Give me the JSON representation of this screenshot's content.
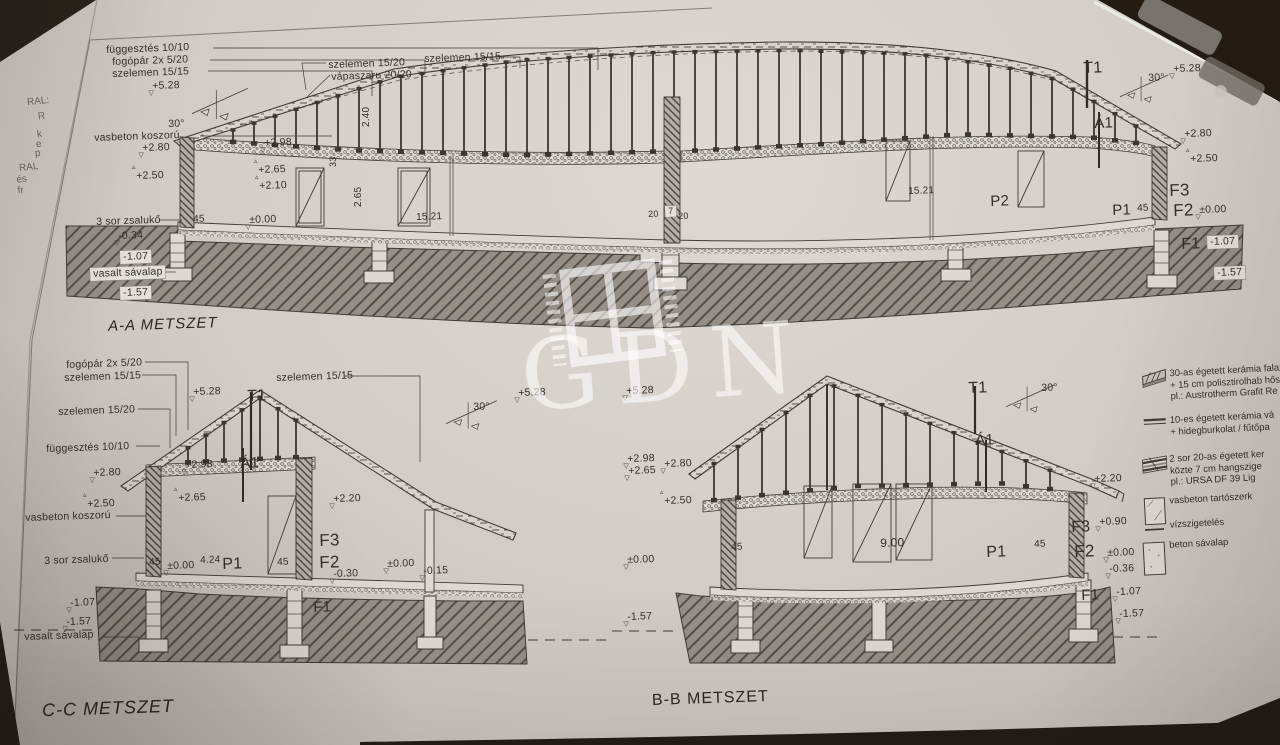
{
  "watermark": {
    "text": "GDN"
  },
  "titles": {
    "aa": "A-A METSZET",
    "cc": "C-C METSZET",
    "bb": "B-B METSZET"
  },
  "symbols": {
    "level_down": "▽",
    "level_up": "▵"
  },
  "colors": {
    "paper": "#d5cfc9",
    "ink": "#3f3b37",
    "ground_hatch": "#968f88",
    "table_dark": "#241b13",
    "watermark_white": "rgba(255,255,255,0.6)"
  },
  "side_sheet": {
    "fragments": [
      {
        "t": "RAL:",
        "x": 27,
        "y": 96
      },
      {
        "t": "R",
        "x": 38,
        "y": 111
      },
      {
        "t": "k",
        "x": 37,
        "y": 129
      },
      {
        "t": "e",
        "x": 36,
        "y": 139
      },
      {
        "t": "p",
        "x": 35,
        "y": 148
      },
      {
        "t": "RAL",
        "x": 19,
        "y": 162
      },
      {
        "t": "és fr",
        "x": 17,
        "y": 174
      }
    ]
  },
  "legend": {
    "items": [
      {
        "icon": "wall-30",
        "lines": [
          "30-as égetett kerámia falaz",
          "+ 15 cm polisztirolhab hős",
          "pl.: Austrotherm Grafit Re"
        ]
      },
      {
        "icon": "partition-10",
        "lines": [
          "10-es égetett kerámia vá",
          "+ hidegburkolat / fűtőpa"
        ]
      },
      {
        "icon": "wall-20x2",
        "lines": [
          "2 sor 20-as égetett ker",
          "közte 7 cm hangszige",
          "pl.: URSA DF 39 Lig"
        ]
      },
      {
        "icon": "rc-structure",
        "lines": [
          "vasbeton tartószerk"
        ]
      },
      {
        "icon": "waterproofing",
        "lines": [
          "vízszigetelés"
        ]
      },
      {
        "icon": "concrete-strip",
        "lines": [
          "beton sávalap"
        ]
      }
    ]
  },
  "annotations": [
    {
      "t": "függesztés 10/10",
      "x": 106,
      "y": 44
    },
    {
      "t": "fogópár 2x 5/20",
      "x": 112,
      "y": 56
    },
    {
      "t": "szelemen 15/15",
      "x": 112,
      "y": 68
    },
    {
      "t": "+5.28",
      "x": 152,
      "y": 80,
      "sym": "d"
    },
    {
      "t": "30°",
      "x": 168,
      "y": 118
    },
    {
      "t": "vasbeton koszorú",
      "x": 94,
      "y": 132
    },
    {
      "t": "+2.80",
      "x": 142,
      "y": 142,
      "sym": "d"
    },
    {
      "t": "+2.50",
      "x": 136,
      "y": 170,
      "sym": "u"
    },
    {
      "t": "szelemen 15/20",
      "x": 328,
      "y": 59
    },
    {
      "t": "vápaszaru 20/20",
      "x": 331,
      "y": 71
    },
    {
      "t": "szelemen 15/15",
      "x": 424,
      "y": 53
    },
    {
      "t": "2.40",
      "x": 361,
      "y": 127,
      "rot": -90,
      "fs": 10
    },
    {
      "t": "+2.98",
      "x": 264,
      "y": 137,
      "sym": "d"
    },
    {
      "t": "33",
      "x": 328,
      "y": 167,
      "rot": -90,
      "fs": 9
    },
    {
      "t": "+2.65",
      "x": 258,
      "y": 164,
      "sym": "u"
    },
    {
      "t": "2.65",
      "x": 353,
      "y": 207,
      "rot": -90,
      "fs": 10
    },
    {
      "t": "+2.10",
      "x": 259,
      "y": 180,
      "sym": "u"
    },
    {
      "t": "3 sor zsalukő",
      "x": 96,
      "y": 216
    },
    {
      "t": "45",
      "x": 193,
      "y": 214,
      "fs": 10
    },
    {
      "t": "±0.00",
      "x": 249,
      "y": 214,
      "sym": "d"
    },
    {
      "t": "15.21",
      "x": 416,
      "y": 212,
      "fs": 10
    },
    {
      "t": "-0.34",
      "x": 118,
      "y": 230,
      "sym": "d"
    },
    {
      "t": "-1.07",
      "x": 120,
      "y": 251,
      "box": true
    },
    {
      "t": "vasalt sávalap",
      "x": 90,
      "y": 268,
      "box": true
    },
    {
      "t": "-1.57",
      "x": 120,
      "y": 287,
      "box": true
    },
    {
      "t": "20",
      "x": 648,
      "y": 209,
      "fs": 9
    },
    {
      "t": "7",
      "x": 665,
      "y": 206,
      "fs": 9,
      "box": true
    },
    {
      "t": "20",
      "x": 678,
      "y": 211,
      "fs": 9
    },
    {
      "t": "15.21",
      "x": 908,
      "y": 186,
      "fs": 10
    },
    {
      "t": "P2",
      "x": 990,
      "y": 193,
      "fs": 15
    },
    {
      "t": "P1",
      "x": 1112,
      "y": 202,
      "fs": 15
    },
    {
      "t": "45",
      "x": 1137,
      "y": 203,
      "fs": 10
    },
    {
      "t": "T1",
      "x": 1083,
      "y": 60,
      "fs": 16
    },
    {
      "t": "30°",
      "x": 1148,
      "y": 72
    },
    {
      "t": "+5.28",
      "x": 1173,
      "y": 63,
      "sym": "d"
    },
    {
      "t": "Á1",
      "x": 1094,
      "y": 115,
      "fs": 15
    },
    {
      "t": "+2.80",
      "x": 1184,
      "y": 128,
      "sym": "d"
    },
    {
      "t": "+2.50",
      "x": 1190,
      "y": 153,
      "sym": "u"
    },
    {
      "t": "F3",
      "x": 1169,
      "y": 181,
      "fs": 17
    },
    {
      "t": "F2",
      "x": 1173,
      "y": 201,
      "fs": 17
    },
    {
      "t": "±0.00",
      "x": 1199,
      "y": 204,
      "sym": "d"
    },
    {
      "t": "F1",
      "x": 1181,
      "y": 236,
      "fs": 16
    },
    {
      "t": "-1.07",
      "x": 1207,
      "y": 236,
      "box": true
    },
    {
      "t": "-1.57",
      "x": 1214,
      "y": 267,
      "box": true
    },
    {
      "t": "fogópár 2x 5/20",
      "x": 66,
      "y": 359
    },
    {
      "t": "szelemen 15/15",
      "x": 64,
      "y": 372
    },
    {
      "t": "szelemen 15/20",
      "x": 58,
      "y": 406
    },
    {
      "t": "függesztés 10/10",
      "x": 46,
      "y": 443
    },
    {
      "t": "+5.28",
      "x": 193,
      "y": 386,
      "sym": "d"
    },
    {
      "t": "T1",
      "x": 247,
      "y": 388,
      "fs": 16
    },
    {
      "t": "szelemen 15/15",
      "x": 276,
      "y": 372
    },
    {
      "t": "30°",
      "x": 473,
      "y": 401
    },
    {
      "t": "+2.98",
      "x": 185,
      "y": 459,
      "sym": "d"
    },
    {
      "t": "Á1",
      "x": 240,
      "y": 455,
      "fs": 15
    },
    {
      "t": "+2.80",
      "x": 93,
      "y": 467,
      "sym": "d"
    },
    {
      "t": "+2.65",
      "x": 178,
      "y": 492,
      "sym": "u"
    },
    {
      "t": "+2.50",
      "x": 87,
      "y": 498,
      "sym": "u"
    },
    {
      "t": "vasbeton koszorú",
      "x": 25,
      "y": 512
    },
    {
      "t": "+2.20",
      "x": 333,
      "y": 493,
      "sym": "d"
    },
    {
      "t": "3 sor zsalukő",
      "x": 44,
      "y": 555
    },
    {
      "t": "45",
      "x": 149,
      "y": 557,
      "fs": 10
    },
    {
      "t": "±0.00",
      "x": 167,
      "y": 560,
      "sym": "d"
    },
    {
      "t": "4.24",
      "x": 200,
      "y": 555,
      "fs": 10
    },
    {
      "t": "P1",
      "x": 222,
      "y": 556,
      "fs": 16
    },
    {
      "t": "45",
      "x": 277,
      "y": 557,
      "fs": 10
    },
    {
      "t": "F3",
      "x": 319,
      "y": 531,
      "fs": 17
    },
    {
      "t": "F2",
      "x": 319,
      "y": 553,
      "fs": 17
    },
    {
      "t": "-0.30",
      "x": 333,
      "y": 568,
      "sym": "d"
    },
    {
      "t": "±0.00",
      "x": 387,
      "y": 558,
      "sym": "d"
    },
    {
      "t": "-0.15",
      "x": 423,
      "y": 565,
      "sym": "d"
    },
    {
      "t": "F1",
      "x": 313,
      "y": 599,
      "fs": 15
    },
    {
      "t": "-1.07",
      "x": 70,
      "y": 597,
      "sym": "d"
    },
    {
      "t": "-1.57",
      "x": 66,
      "y": 616,
      "sym": "d"
    },
    {
      "t": "vasalt sávalap",
      "x": 24,
      "y": 631
    },
    {
      "t": "+5.28",
      "x": 518,
      "y": 387,
      "sym": "d"
    },
    {
      "t": "+5.28",
      "x": 626,
      "y": 385,
      "sym": "d"
    },
    {
      "t": "+2.98",
      "x": 627,
      "y": 453,
      "sym": "d"
    },
    {
      "t": "+2.65",
      "x": 628,
      "y": 465,
      "sym": "d"
    },
    {
      "t": "+2.80",
      "x": 664,
      "y": 458,
      "sym": "d"
    },
    {
      "t": "+2.50",
      "x": 664,
      "y": 495,
      "sym": "u"
    },
    {
      "t": "±0.00",
      "x": 627,
      "y": 554,
      "sym": "d"
    },
    {
      "t": "-1.57",
      "x": 627,
      "y": 611,
      "sym": "d"
    },
    {
      "t": "T1",
      "x": 968,
      "y": 380,
      "fs": 16
    },
    {
      "t": "30°",
      "x": 1041,
      "y": 382
    },
    {
      "t": "Á1",
      "x": 975,
      "y": 432,
      "fs": 15
    },
    {
      "t": "+2.20",
      "x": 1094,
      "y": 473,
      "sym": "d"
    },
    {
      "t": "45",
      "x": 731,
      "y": 542,
      "fs": 10
    },
    {
      "t": "9.00",
      "x": 880,
      "y": 536,
      "fs": 12
    },
    {
      "t": "P1",
      "x": 986,
      "y": 544,
      "fs": 16
    },
    {
      "t": "45",
      "x": 1034,
      "y": 539,
      "fs": 10
    },
    {
      "t": "F3",
      "x": 1071,
      "y": 519,
      "fs": 16
    },
    {
      "t": "+0.90",
      "x": 1099,
      "y": 516,
      "sym": "d"
    },
    {
      "t": "F2",
      "x": 1074,
      "y": 542,
      "fs": 17
    },
    {
      "t": "±0.00",
      "x": 1107,
      "y": 547,
      "sym": "d"
    },
    {
      "t": "-0.36",
      "x": 1109,
      "y": 563,
      "sym": "d"
    },
    {
      "t": "F1",
      "x": 1081,
      "y": 587,
      "fs": 15
    },
    {
      "t": "-1.07",
      "x": 1116,
      "y": 586,
      "sym": "d"
    },
    {
      "t": "-1.57",
      "x": 1119,
      "y": 608,
      "sym": "d"
    }
  ]
}
